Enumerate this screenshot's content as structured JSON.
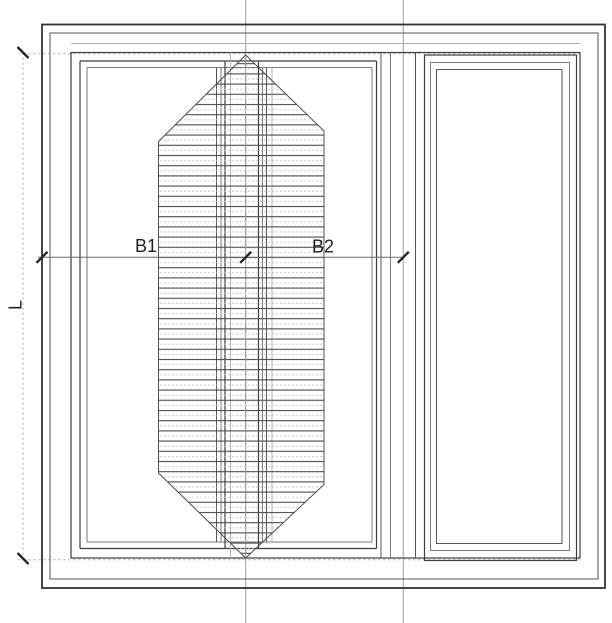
{
  "page": {
    "background": "#ffffff",
    "description": "CAD elevation drawing of a three-panel sliding window with hatched glazing area and dimension lines"
  },
  "drawing": {
    "type": "window-elevation",
    "labels": {
      "b1": "B1",
      "b2": "B2",
      "l": "L"
    }
  },
  "colors": {
    "line_dark": "#333333",
    "line_medium": "#565656",
    "line_soft": "#7a7a7a",
    "line_light": "#b5b5b5",
    "construction_gray": "#a6a6a6",
    "extension_gray": "#b8b8b8",
    "hatch_dark": "#4a4a4a",
    "hatch_light": "#c2c2c2",
    "tick_color": "#262626",
    "text_color": "#1f1f1f"
  }
}
